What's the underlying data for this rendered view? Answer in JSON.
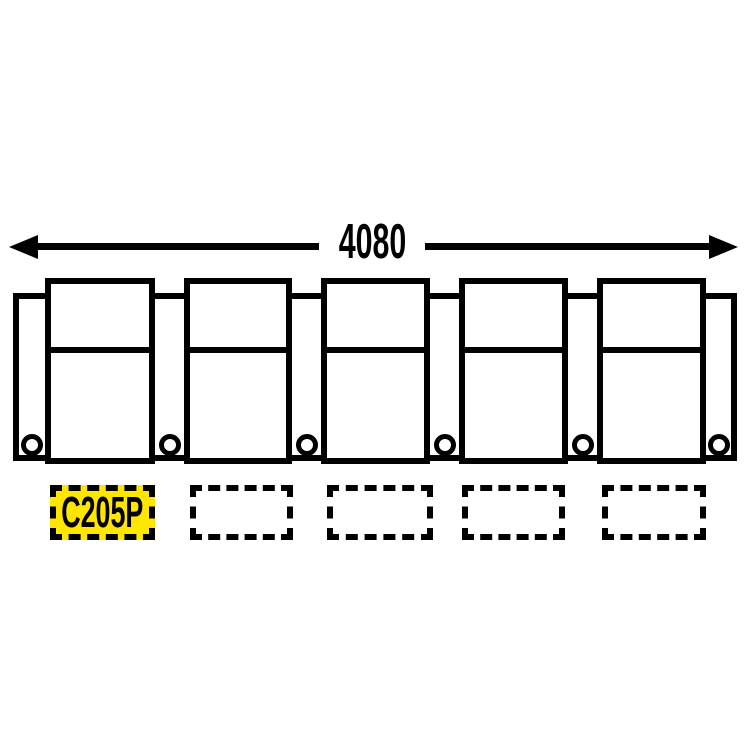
{
  "dimension": {
    "label": "4080"
  },
  "row": {
    "seat_count": 5,
    "armrest_count": 6,
    "cupholder_count": 6
  },
  "slots": {
    "boxes": [
      {
        "text": "C205P",
        "highlighted": true
      },
      {
        "text": "",
        "highlighted": false
      },
      {
        "text": "",
        "highlighted": false
      },
      {
        "text": "",
        "highlighted": false
      },
      {
        "text": "",
        "highlighted": false
      }
    ]
  },
  "colors": {
    "line": "#000000",
    "highlight": "#FFE600",
    "background": "#FFFFFF"
  }
}
